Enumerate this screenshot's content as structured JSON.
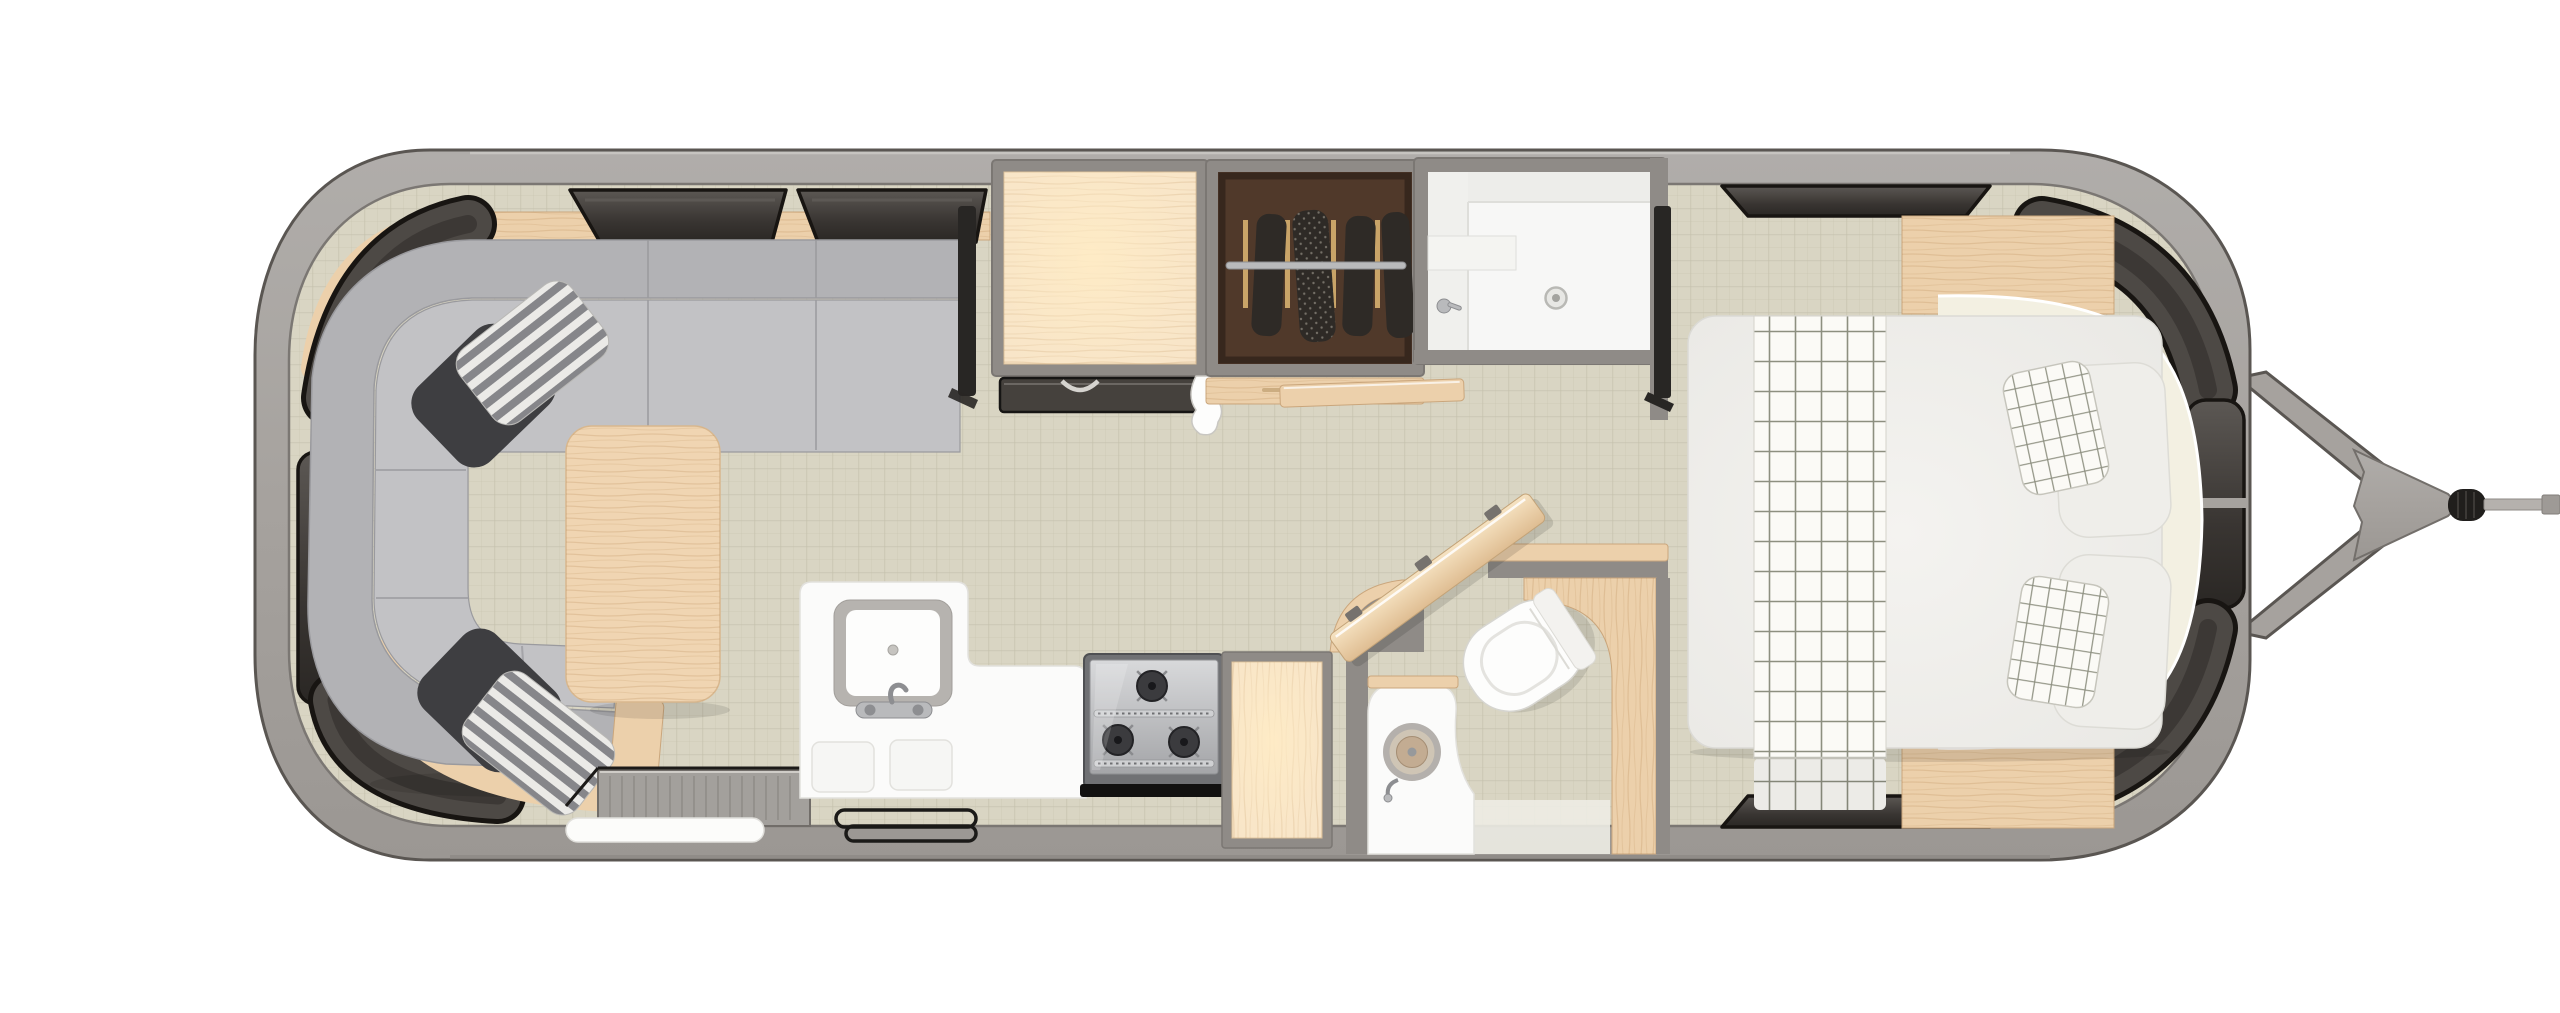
{
  "meta": {
    "title": "Travel trailer floor plan - top-down 3D render",
    "view": "top-down",
    "orientation": "hitch-right"
  },
  "palette": {
    "pageBg": "#ffffff",
    "shell": "#a6a29e",
    "shellEdge": "#5a5652",
    "shellHi": "#c9c6c2",
    "shellShadow": "#8b8783",
    "wallGray": "#8f8b87",
    "wallLine": "#7b7773",
    "floor": "#d9d5c3",
    "floorLine": "#c3bfab",
    "windowFill": "#4d4945",
    "windowDeep": "#2b2826",
    "windowStroke": "#181512",
    "sofaBack": "#b2b2b5",
    "sofaSeat": "#c2c2c5",
    "sofaLine": "#9a9a9e",
    "cushionDark": "#3e3e41",
    "stripeLight": "#ebeae7",
    "stripeDark": "#86868a",
    "wood": "#ecd0ab",
    "woodLight": "#f7e4c8",
    "woodGrain": "#caa67c",
    "woodEdge": "#d9bd96",
    "tableWood": "#f0d5b2",
    "counter": "#fbfbfa",
    "counterLine": "#e2e1dd",
    "white": "#fdfdfc",
    "steel": "#b9babc",
    "steelDark": "#8d8e91",
    "stoveBody": "#707174",
    "burner": "#3b3b3e",
    "black": "#161514",
    "wardrobeIn": "#50392a",
    "clothes": "#2e2a26",
    "hanger": "#c9a468",
    "bath": "#f7f7f6",
    "bathLine": "#dededa",
    "bedSheet": "#f1f0ed",
    "bedLine": "#dbdad5",
    "runner": "#fbfaf6",
    "runnerLine": "#8d8f80",
    "cream": "#f3f0e2",
    "tv": "#282624",
    "shadow": "rgba(0,0,0,0.10)"
  },
  "zones": [
    {
      "name": "rear-lounge",
      "items": [
        "u-shaped-sofa",
        "dark-throw-pillows",
        "striped-throw-pillows",
        "coffee-table",
        "lounge-tv",
        "wood-shelf",
        "wraparound-windows",
        "overhead-windows"
      ]
    },
    {
      "name": "galley",
      "items": [
        "kitchen-counter",
        "square-sink",
        "kitchen-faucet",
        "sink-covers",
        "three-burner-stove",
        "oven-handle",
        "refrigerator-cabinet",
        "refrigerator-front",
        "pantry-cabinet",
        "furnace-grate",
        "entry-step",
        "entry-door-rails",
        "hand-towel"
      ]
    },
    {
      "name": "wardrobe",
      "items": [
        "hanging-rod",
        "wood-hangers",
        "hanging-clothes",
        "wardrobe-front"
      ]
    },
    {
      "name": "bathroom",
      "items": [
        "shower-stall",
        "shower-drain",
        "shower-valve",
        "bathroom-door",
        "toilet",
        "round-vanity-sink",
        "vanity-counter",
        "privacy-wall"
      ]
    },
    {
      "name": "front-bedroom",
      "items": [
        "queen-bed",
        "plaid-runner",
        "sleeping-pillows",
        "plaid-accent-pillows",
        "curved-headboard",
        "nightstand-top",
        "nightstand-bottom",
        "bedroom-tv",
        "overhead-lockers",
        "wraparound-windows"
      ]
    },
    {
      "name": "exterior",
      "items": [
        "a-frame-tongue",
        "tongue-plate",
        "coupler",
        "jack-rod"
      ]
    }
  ]
}
